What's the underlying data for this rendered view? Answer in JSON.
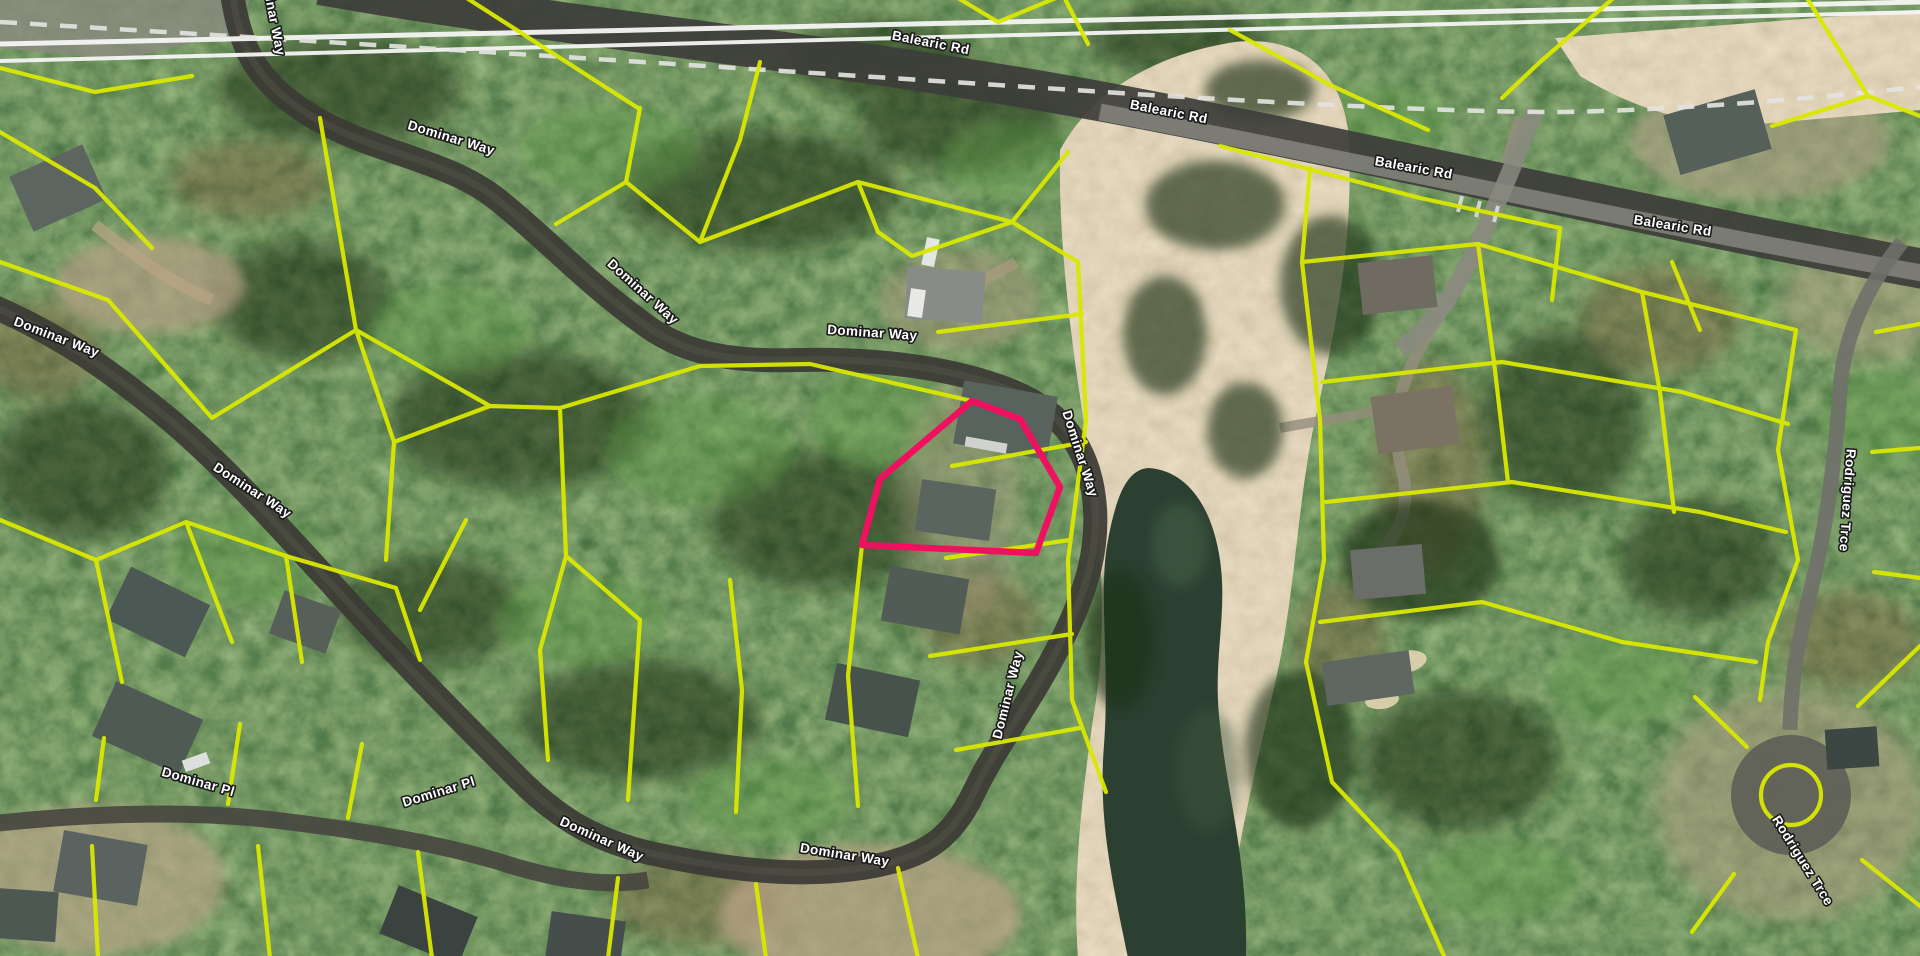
{
  "map": {
    "type": "satellite-parcel-view",
    "street_names": [
      "Balearic Rd",
      "Dominar Way",
      "Dominar Pl",
      "Rodriguez Trce"
    ],
    "colors": {
      "parcel_line": "#d9e800",
      "highlight_parcel": "#ef1160",
      "road_label_fill": "#ffffff",
      "road_label_halo": "#1b1b1b",
      "utility_line": "#f6f6f4",
      "dashed_boundary": "#e3e3df"
    }
  },
  "road_labels": [
    {
      "text": "Balearic Rd"
    },
    {
      "text": "Balearic Rd"
    },
    {
      "text": "Balearic Rd"
    },
    {
      "text": "Balearic Rd"
    },
    {
      "text": "Dominar Way"
    },
    {
      "text": "Dominar Way"
    },
    {
      "text": "Dominar Way"
    },
    {
      "text": "Dominar Way"
    },
    {
      "text": "Dominar Way"
    },
    {
      "text": "Dominar Way"
    },
    {
      "text": "Dominar Way"
    },
    {
      "text": "Dominar Way"
    },
    {
      "text": "Dominar Way"
    },
    {
      "text": "Dominar Way"
    },
    {
      "text": "Dominar Pl"
    },
    {
      "text": "Dominar Pl"
    },
    {
      "text": "Rodriguez Trce"
    },
    {
      "text": "Rodriguez Trce"
    }
  ]
}
